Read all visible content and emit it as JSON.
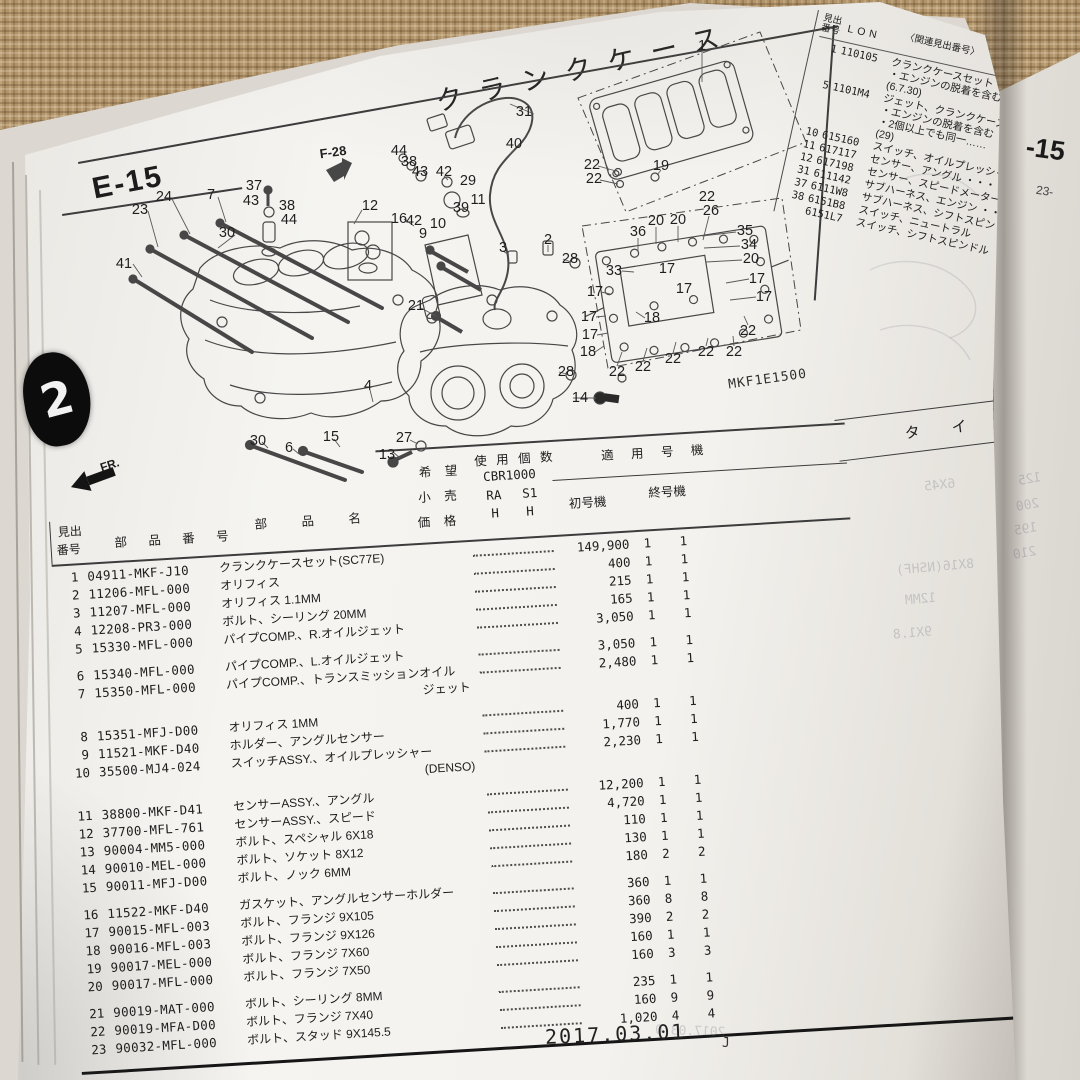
{
  "page": {
    "title": "クランクケース",
    "section_code": "E-15",
    "diagram_code": "MKF1E1500",
    "ref_tag": "F-28",
    "fr_arrow_label": "FR.",
    "tab_number": "2",
    "footer": {
      "date": "2017.03.01",
      "mark": "J"
    }
  },
  "edge_page": {
    "code": "-15",
    "note": "23-"
  },
  "type_band": {
    "label": "タ イ プ"
  },
  "related_table": {
    "header": {
      "no_line1": "見出",
      "no_line2": "番号",
      "code": "LON",
      "related": "〈関連見出番号〉",
      "service": "整 備"
    },
    "rows": [
      {
        "no": "1",
        "code": "110105",
        "desc": [
          "クランクケースセット ・・・・",
          "・エンジンの脱着を含む",
          "(6.7.30)"
        ]
      },
      {
        "no": "5",
        "code": "1101M4",
        "desc": [
          "ジェット、クランクケースオイル",
          "・エンジンの脱着を含む",
          "・2個以上でも同一……",
          "(29)"
        ]
      },
      {
        "no": "10",
        "code": "615160",
        "desc": [
          "スイッチ、オイルプレッシャー"
        ]
      },
      {
        "no": "11",
        "code": "617117",
        "desc": [
          "センサー、アングル ・・・"
        ]
      },
      {
        "no": "12",
        "code": "617198",
        "desc": [
          "センサー、スピードメーター"
        ]
      },
      {
        "no": "31",
        "code": "611142",
        "desc": [
          "サブハーネス、エンジン ・・"
        ]
      },
      {
        "no": "37",
        "code": "6111W8",
        "desc": [
          "サブハーネス、シフトスピンドル"
        ]
      },
      {
        "no": "38",
        "code": "6151B8",
        "desc": [
          "スイッチ、ニュートラル"
        ]
      },
      {
        "no": "",
        "code": "6151L7",
        "desc": [
          "スイッチ、シフトスピンドル"
        ]
      }
    ]
  },
  "parts_table": {
    "header": {
      "no1": "見出",
      "no2": "番号",
      "part": "部 品 番 号",
      "name": "部　品　名",
      "price1": "希 望",
      "price2": "小 売",
      "price3": "価 格",
      "qty": "使 用 個 数",
      "model": "CBR1000",
      "ra": "RA",
      "s1": "S1",
      "h1": "H",
      "h2": "H",
      "apply": "適 用 号 機",
      "first": "初号機",
      "last": "終号機"
    },
    "rows": [
      {
        "no": "1",
        "part": "04911-MKF-J10",
        "name": "クランクケースセット(SC77E)",
        "name2": "",
        "price": "149,900",
        "ra": "1",
        "s1": "1",
        "gap": false
      },
      {
        "no": "2",
        "part": "11206-MFL-000",
        "name": "オリフィス",
        "name2": "",
        "price": "400",
        "ra": "1",
        "s1": "1",
        "gap": false
      },
      {
        "no": "3",
        "part": "11207-MFL-000",
        "name": "オリフィス 1.1MM",
        "name2": "",
        "price": "215",
        "ra": "1",
        "s1": "1",
        "gap": false
      },
      {
        "no": "4",
        "part": "12208-PR3-000",
        "name": "ボルト、シーリング 20MM",
        "name2": "",
        "price": "165",
        "ra": "1",
        "s1": "1",
        "gap": false
      },
      {
        "no": "5",
        "part": "15330-MFL-000",
        "name": "パイプCOMP.、R.オイルジェット",
        "name2": "",
        "price": "3,050",
        "ra": "1",
        "s1": "1",
        "gap": false
      },
      {
        "no": "6",
        "part": "15340-MFL-000",
        "name": "パイプCOMP.、L.オイルジェット",
        "name2": "",
        "price": "3,050",
        "ra": "1",
        "s1": "1",
        "gap": true
      },
      {
        "no": "7",
        "part": "15350-MFL-000",
        "name": "パイプCOMP.、トランスミッションオイル",
        "name2": "ジェット",
        "price": "2,480",
        "ra": "1",
        "s1": "1",
        "gap": false
      },
      {
        "no": "8",
        "part": "15351-MFJ-D00",
        "name": "オリフィス 1MM",
        "name2": "",
        "price": "400",
        "ra": "1",
        "s1": "1",
        "gap": true
      },
      {
        "no": "9",
        "part": "11521-MKF-D40",
        "name": "ホルダー、アングルセンサー",
        "name2": "",
        "price": "1,770",
        "ra": "1",
        "s1": "1",
        "gap": false
      },
      {
        "no": "10",
        "part": "35500-MJ4-024",
        "name": "スイッチASSY.、オイルプレッシャー",
        "name2": "(DENSO)",
        "price": "2,230",
        "ra": "1",
        "s1": "1",
        "gap": false
      },
      {
        "no": "11",
        "part": "38800-MKF-D41",
        "name": "センサーASSY.、アングル",
        "name2": "",
        "price": "12,200",
        "ra": "1",
        "s1": "1",
        "gap": true
      },
      {
        "no": "12",
        "part": "37700-MFL-761",
        "name": "センサーASSY.、スピード",
        "name2": "",
        "price": "4,720",
        "ra": "1",
        "s1": "1",
        "gap": false
      },
      {
        "no": "13",
        "part": "90004-MM5-000",
        "name": "ボルト、スペシャル 6X18",
        "name2": "",
        "price": "110",
        "ra": "1",
        "s1": "1",
        "gap": false
      },
      {
        "no": "14",
        "part": "90010-MEL-000",
        "name": "ボルト、ソケット 8X12",
        "name2": "",
        "price": "130",
        "ra": "1",
        "s1": "1",
        "gap": false
      },
      {
        "no": "15",
        "part": "90011-MFJ-D00",
        "name": "ボルト、ノック 6MM",
        "name2": "",
        "price": "180",
        "ra": "2",
        "s1": "2",
        "gap": false
      },
      {
        "no": "16",
        "part": "11522-MKF-D40",
        "name": "ガスケット、アングルセンサーホルダー",
        "name2": "",
        "price": "360",
        "ra": "1",
        "s1": "1",
        "gap": true
      },
      {
        "no": "17",
        "part": "90015-MFL-003",
        "name": "ボルト、フランジ 9X105",
        "name2": "",
        "price": "360",
        "ra": "8",
        "s1": "8",
        "gap": false
      },
      {
        "no": "18",
        "part": "90016-MFL-003",
        "name": "ボルト、フランジ 9X126",
        "name2": "",
        "price": "390",
        "ra": "2",
        "s1": "2",
        "gap": false
      },
      {
        "no": "19",
        "part": "90017-MEL-000",
        "name": "ボルト、フランジ 7X60",
        "name2": "",
        "price": "160",
        "ra": "1",
        "s1": "1",
        "gap": false
      },
      {
        "no": "20",
        "part": "90017-MFL-000",
        "name": "ボルト、フランジ 7X50",
        "name2": "",
        "price": "160",
        "ra": "3",
        "s1": "3",
        "gap": false
      },
      {
        "no": "21",
        "part": "90019-MAT-000",
        "name": "ボルト、シーリング 8MM",
        "name2": "",
        "price": "235",
        "ra": "1",
        "s1": "1",
        "gap": true
      },
      {
        "no": "22",
        "part": "90019-MFA-D00",
        "name": "ボルト、フランジ 7X40",
        "name2": "",
        "price": "160",
        "ra": "9",
        "s1": "9",
        "gap": false
      },
      {
        "no": "23",
        "part": "90032-MFL-000",
        "name": "ボルト、スタッド 9X145.5",
        "name2": "",
        "price": "1,020",
        "ra": "4",
        "s1": "4",
        "gap": false
      }
    ]
  },
  "diagram": {
    "callouts": [
      {
        "n": "1",
        "x": 702,
        "y": 46
      },
      {
        "n": "31",
        "x": 524,
        "y": 112
      },
      {
        "n": "40",
        "x": 514,
        "y": 144
      },
      {
        "n": "29",
        "x": 468,
        "y": 181
      },
      {
        "n": "11",
        "x": 478,
        "y": 200
      },
      {
        "n": "39",
        "x": 461,
        "y": 208
      },
      {
        "n": "12",
        "x": 370,
        "y": 206
      },
      {
        "n": "44",
        "x": 399,
        "y": 151
      },
      {
        "n": "38",
        "x": 409,
        "y": 162
      },
      {
        "n": "43",
        "x": 420,
        "y": 172
      },
      {
        "n": "42",
        "x": 444,
        "y": 172
      },
      {
        "n": "16",
        "x": 399,
        "y": 219
      },
      {
        "n": "42",
        "x": 414,
        "y": 221
      },
      {
        "n": "9",
        "x": 423,
        "y": 234
      },
      {
        "n": "10",
        "x": 438,
        "y": 224
      },
      {
        "n": "37",
        "x": 254,
        "y": 186
      },
      {
        "n": "43",
        "x": 251,
        "y": 201
      },
      {
        "n": "38",
        "x": 287,
        "y": 206
      },
      {
        "n": "44",
        "x": 289,
        "y": 220
      },
      {
        "n": "23",
        "x": 140,
        "y": 210
      },
      {
        "n": "24",
        "x": 164,
        "y": 197
      },
      {
        "n": "7",
        "x": 211,
        "y": 195
      },
      {
        "n": "41",
        "x": 124,
        "y": 264
      },
      {
        "n": "30",
        "x": 227,
        "y": 233
      },
      {
        "n": "21",
        "x": 416,
        "y": 306
      },
      {
        "n": "2",
        "x": 548,
        "y": 240
      },
      {
        "n": "3",
        "x": 503,
        "y": 248
      },
      {
        "n": "28",
        "x": 570,
        "y": 259
      },
      {
        "n": "28",
        "x": 566,
        "y": 372
      },
      {
        "n": "14",
        "x": 580,
        "y": 398
      },
      {
        "n": "13",
        "x": 387,
        "y": 455
      },
      {
        "n": "27",
        "x": 404,
        "y": 438
      },
      {
        "n": "30",
        "x": 258,
        "y": 441
      },
      {
        "n": "6",
        "x": 289,
        "y": 448
      },
      {
        "n": "15",
        "x": 331,
        "y": 437
      },
      {
        "n": "4",
        "x": 368,
        "y": 386
      },
      {
        "n": "22",
        "x": 592,
        "y": 165
      },
      {
        "n": "22",
        "x": 594,
        "y": 179
      },
      {
        "n": "19",
        "x": 661,
        "y": 166
      },
      {
        "n": "22",
        "x": 707,
        "y": 197
      },
      {
        "n": "26",
        "x": 711,
        "y": 211
      },
      {
        "n": "35",
        "x": 745,
        "y": 231
      },
      {
        "n": "34",
        "x": 749,
        "y": 245
      },
      {
        "n": "20",
        "x": 751,
        "y": 259
      },
      {
        "n": "36",
        "x": 638,
        "y": 232
      },
      {
        "n": "20",
        "x": 656,
        "y": 221
      },
      {
        "n": "20",
        "x": 678,
        "y": 220
      },
      {
        "n": "33",
        "x": 614,
        "y": 271
      },
      {
        "n": "17",
        "x": 595,
        "y": 292
      },
      {
        "n": "17",
        "x": 589,
        "y": 317
      },
      {
        "n": "17",
        "x": 590,
        "y": 335
      },
      {
        "n": "17",
        "x": 667,
        "y": 269
      },
      {
        "n": "17",
        "x": 684,
        "y": 289
      },
      {
        "n": "17",
        "x": 757,
        "y": 279
      },
      {
        "n": "17",
        "x": 764,
        "y": 297
      },
      {
        "n": "18",
        "x": 652,
        "y": 318
      },
      {
        "n": "18",
        "x": 588,
        "y": 352
      },
      {
        "n": "22",
        "x": 617,
        "y": 372
      },
      {
        "n": "22",
        "x": 643,
        "y": 367
      },
      {
        "n": "22",
        "x": 673,
        "y": 359
      },
      {
        "n": "22",
        "x": 706,
        "y": 352
      },
      {
        "n": "22",
        "x": 734,
        "y": 352
      },
      {
        "n": "22",
        "x": 748,
        "y": 331
      }
    ]
  },
  "ghosts": [
    {
      "text": "6X45",
      "x": 924,
      "y": 478,
      "rot": 6
    },
    {
      "text": "8X16(NSHF)",
      "x": 896,
      "y": 560,
      "rot": 5
    },
    {
      "text": "12MM",
      "x": 905,
      "y": 592,
      "rot": 5
    },
    {
      "text": "9X1.8",
      "x": 893,
      "y": 626,
      "rot": 5
    },
    {
      "text": "125",
      "x": 1018,
      "y": 472,
      "rot": 10
    },
    {
      "text": "200",
      "x": 1016,
      "y": 498,
      "rot": 10
    },
    {
      "text": "195",
      "x": 1014,
      "y": 522,
      "rot": 10
    },
    {
      "text": "210",
      "x": 1013,
      "y": 546,
      "rot": 10
    },
    {
      "text": "2017.03.0",
      "x": 655,
      "y": 1024,
      "rot": -2
    }
  ]
}
